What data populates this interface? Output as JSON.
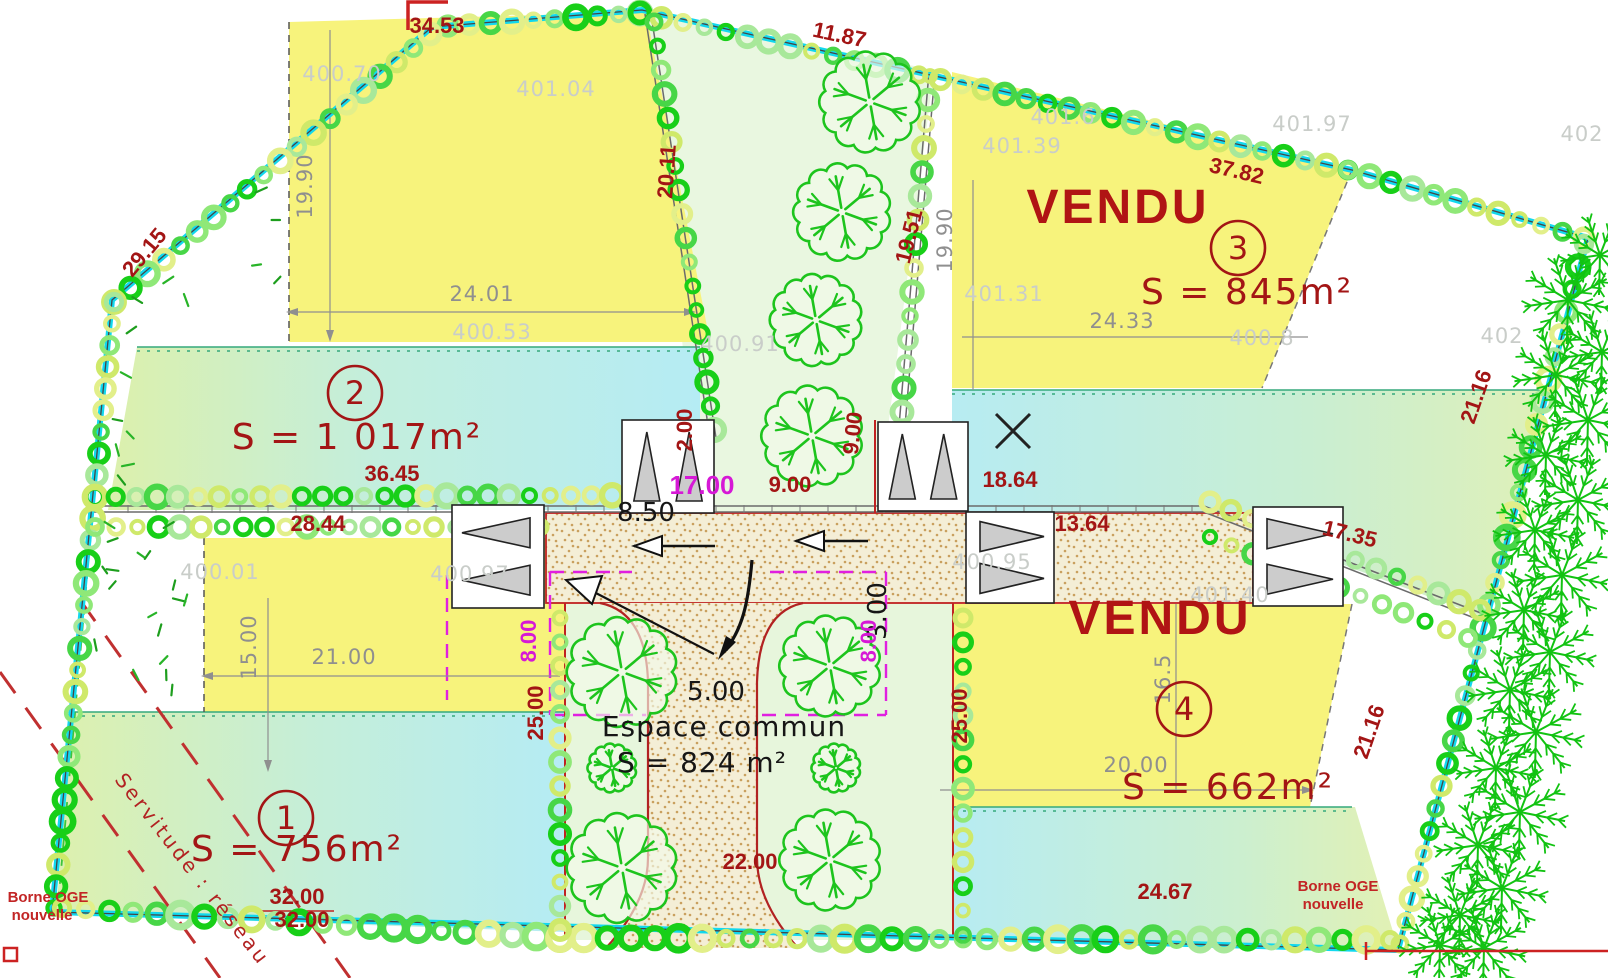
{
  "plan": {
    "lots": [
      {
        "number": "1",
        "area_label": "S = 756m²",
        "status": ""
      },
      {
        "number": "2",
        "area_label": "S = 1 017m²",
        "status": ""
      },
      {
        "number": "3",
        "area_label": "S = 845m²",
        "status": "VENDU"
      },
      {
        "number": "4",
        "area_label": "S = 662m²",
        "status": "VENDU"
      }
    ],
    "common_area": {
      "name": "Espace commun",
      "area_label": "S = 824 m²"
    },
    "survey_notes": [
      "Borne OGE nouvelle",
      "Borne OGE nouvelle",
      "Servitude : réseau"
    ],
    "colors": {
      "boundary_cyan": "#12d8ee",
      "lot_yellow": "#f7f37c",
      "hedge_green": "#18cf18",
      "dim_red": "#a31515",
      "dim_magenta": "#d619d6",
      "elev_gray": "#c9cdc9",
      "espace_green": "#e7f6dc",
      "road_beige": "#f4eed6",
      "vendu_red": "#b01414"
    }
  },
  "circled_numbers": [
    {
      "t": "2",
      "x": 355,
      "y": 393
    },
    {
      "t": "3",
      "x": 1238,
      "y": 248
    },
    {
      "t": "1",
      "x": 286,
      "y": 818
    },
    {
      "t": "4",
      "x": 1184,
      "y": 709
    }
  ],
  "labels": [
    {
      "t": "34.53",
      "x": 437,
      "y": 33,
      "c": "dim"
    },
    {
      "t": "29.15",
      "x": 150,
      "y": 257,
      "c": "dim",
      "r": -50
    },
    {
      "t": "11.87",
      "x": 838,
      "y": 42,
      "c": "dim",
      "r": 12
    },
    {
      "t": "20.11",
      "x": 674,
      "y": 172,
      "c": "dim",
      "r": -86
    },
    {
      "t": "19.51",
      "x": 916,
      "y": 238,
      "c": "dim",
      "r": -76
    },
    {
      "t": "37.82",
      "x": 1235,
      "y": 178,
      "c": "dim",
      "r": 13
    },
    {
      "t": "36.45",
      "x": 392,
      "y": 481,
      "c": "dim"
    },
    {
      "t": "28.44",
      "x": 318,
      "y": 531,
      "c": "dim"
    },
    {
      "t": "18.64",
      "x": 1010,
      "y": 487,
      "c": "dim"
    },
    {
      "t": "13.64",
      "x": 1082,
      "y": 531,
      "c": "dim"
    },
    {
      "t": "2.00",
      "x": 692,
      "y": 430,
      "c": "dim",
      "r": -90
    },
    {
      "t": "9.00",
      "x": 790,
      "y": 492,
      "c": "dim"
    },
    {
      "t": "9.00",
      "x": 860,
      "y": 434,
      "c": "dim",
      "r": -84
    },
    {
      "t": "25.00",
      "x": 543,
      "y": 713,
      "c": "dim",
      "r": -90
    },
    {
      "t": "25.00",
      "x": 967,
      "y": 716,
      "c": "dim",
      "r": -90
    },
    {
      "t": "22.00",
      "x": 750,
      "y": 869,
      "c": "dim"
    },
    {
      "t": "32.00",
      "x": 297,
      "y": 904,
      "c": "dim"
    },
    {
      "t": "32.00",
      "x": 302,
      "y": 927,
      "c": "dim"
    },
    {
      "t": "24.67",
      "x": 1165,
      "y": 899,
      "c": "dim"
    },
    {
      "t": "21.16",
      "x": 1483,
      "y": 399,
      "c": "dim",
      "r": -71
    },
    {
      "t": "21.16",
      "x": 1376,
      "y": 734,
      "c": "dim",
      "r": -71
    },
    {
      "t": "17.35",
      "x": 1348,
      "y": 541,
      "c": "dim",
      "r": 14
    },
    {
      "t": "8.50",
      "x": 646,
      "y": 521,
      "c": "dimB"
    },
    {
      "t": "3.00",
      "x": 886,
      "y": 611,
      "c": "dimB",
      "r": -90
    },
    {
      "t": "5.00",
      "x": 716,
      "y": 700,
      "c": "dimB"
    },
    {
      "t": "17.00",
      "x": 702,
      "y": 494,
      "c": "dimM"
    },
    {
      "t": "8.00",
      "x": 536,
      "y": 641,
      "c": "dimM2",
      "r": -90
    },
    {
      "t": "8.00",
      "x": 876,
      "y": 641,
      "c": "dimM2",
      "r": -90
    },
    {
      "t": "Espace commun",
      "x": 724,
      "y": 736,
      "c": "esp"
    },
    {
      "t": "S = 824 m²",
      "x": 702,
      "y": 772,
      "c": "esp"
    },
    {
      "t": "S = 1 017m²",
      "x": 357,
      "y": 449,
      "c": "area"
    },
    {
      "t": "S = 845m²",
      "x": 1247,
      "y": 304,
      "c": "area"
    },
    {
      "t": "S = 756m²",
      "x": 297,
      "y": 861,
      "c": "area"
    },
    {
      "t": "S = 662m²",
      "x": 1228,
      "y": 799,
      "c": "area"
    },
    {
      "t": "VENDU",
      "x": 1118,
      "y": 223,
      "c": "vendu"
    },
    {
      "t": "VENDU",
      "x": 1160,
      "y": 634,
      "c": "vendu"
    },
    {
      "t": "400.70",
      "x": 342,
      "y": 81,
      "c": "elev"
    },
    {
      "t": "401.04",
      "x": 556,
      "y": 96,
      "c": "elev"
    },
    {
      "t": "400.53",
      "x": 492,
      "y": 339,
      "c": "elev"
    },
    {
      "t": "400.91",
      "x": 740,
      "y": 351,
      "c": "elev"
    },
    {
      "t": "401.39",
      "x": 1022,
      "y": 153,
      "c": "elev"
    },
    {
      "t": "401.6",
      "x": 1063,
      "y": 124,
      "c": "elev"
    },
    {
      "t": "401.97",
      "x": 1312,
      "y": 131,
      "c": "elev"
    },
    {
      "t": "402",
      "x": 1582,
      "y": 141,
      "c": "elev"
    },
    {
      "t": "401.31",
      "x": 1004,
      "y": 301,
      "c": "elev"
    },
    {
      "t": "400.8",
      "x": 1262,
      "y": 345,
      "c": "elev"
    },
    {
      "t": "402",
      "x": 1502,
      "y": 343,
      "c": "elev"
    },
    {
      "t": "401.40",
      "x": 1230,
      "y": 602,
      "c": "elev"
    },
    {
      "t": "400.95",
      "x": 992,
      "y": 569,
      "c": "elev"
    },
    {
      "t": "400.01",
      "x": 220,
      "y": 579,
      "c": "elev"
    },
    {
      "t": "400.97",
      "x": 470,
      "y": 581,
      "c": "elev"
    },
    {
      "t": "19.90",
      "x": 312,
      "y": 186,
      "c": "dimG",
      "r": -90
    },
    {
      "t": "24.01",
      "x": 482,
      "y": 301,
      "c": "dimG"
    },
    {
      "t": "19.90",
      "x": 952,
      "y": 240,
      "c": "dimG",
      "r": -90
    },
    {
      "t": "24.33",
      "x": 1122,
      "y": 328,
      "c": "dimG"
    },
    {
      "t": "15.00",
      "x": 256,
      "y": 647,
      "c": "dimG",
      "r": -90
    },
    {
      "t": "21.00",
      "x": 344,
      "y": 664,
      "c": "dimG"
    },
    {
      "t": "16.5",
      "x": 1170,
      "y": 679,
      "c": "dimG",
      "r": -90
    },
    {
      "t": "20.00",
      "x": 1136,
      "y": 772,
      "c": "dimG"
    },
    {
      "t": "Borne OGE",
      "x": 48,
      "y": 902,
      "c": "note"
    },
    {
      "t": "nouvelle",
      "x": 42,
      "y": 920,
      "c": "note"
    },
    {
      "t": "Borne OGE",
      "x": 1338,
      "y": 891,
      "c": "note"
    },
    {
      "t": "nouvelle",
      "x": 1333,
      "y": 909,
      "c": "note"
    },
    {
      "t": "Servitude : réseau",
      "x": 114,
      "y": 780,
      "c": "serv",
      "r": 52,
      "a": "start"
    }
  ]
}
